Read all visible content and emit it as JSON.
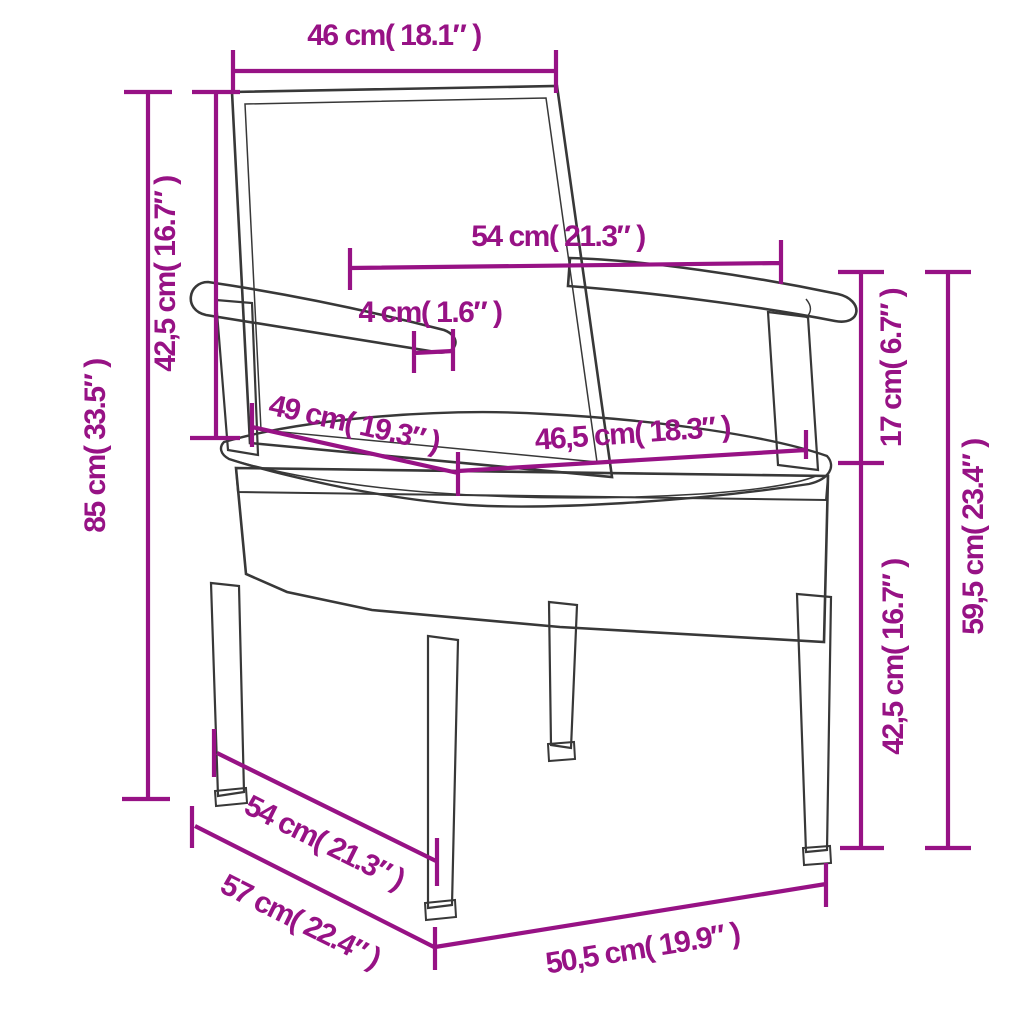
{
  "diagram": {
    "subject": "garden-chair-with-cushion",
    "view": "front-three-quarter line drawing with poly rattan weave texture"
  },
  "accent_color": "#971285",
  "line_color": "#383838",
  "cushion_color": "#faf9f5",
  "dimensions": {
    "backrest_width": {
      "cm": "46",
      "inch": "18.1",
      "label": "46 cm( 18.1″ )"
    },
    "total_height": {
      "cm": "85",
      "inch": "33.5",
      "label": "85 cm( 33.5″ )"
    },
    "backrest_height": {
      "cm": "42,5",
      "inch": "16.7",
      "label": "42,5 cm( 16.7″ )"
    },
    "armrest_span": {
      "cm": "54",
      "inch": "21.3",
      "label": "54 cm( 21.3″ )"
    },
    "armrest_thickness": {
      "cm": "4",
      "inch": "1.6",
      "label": "4 cm( 1.6″ )"
    },
    "seat_depth": {
      "cm": "49",
      "inch": "19.3",
      "label": "49 cm( 19.3″ )"
    },
    "seat_width": {
      "cm": "46,5",
      "inch": "18.3",
      "label": "46,5 cm( 18.3″ )"
    },
    "arm_above_seat": {
      "cm": "17",
      "inch": "6.7",
      "label": "17 cm( 6.7″ )"
    },
    "seat_height": {
      "cm": "42,5",
      "inch": "16.7",
      "label": "42,5 cm( 16.7″ )"
    },
    "armrest_height": {
      "cm": "59,5",
      "inch": "23.4",
      "label": "59,5 cm( 23.4″ )"
    },
    "base_depth": {
      "cm": "54",
      "inch": "21.3",
      "label": "54 cm( 21.3″ )"
    },
    "overall_depth": {
      "cm": "57",
      "inch": "22.4",
      "label": "57 cm( 22.4″ )"
    },
    "base_width": {
      "cm": "50,5",
      "inch": "19.9",
      "label": "50,5 cm( 19.9″ )"
    }
  }
}
